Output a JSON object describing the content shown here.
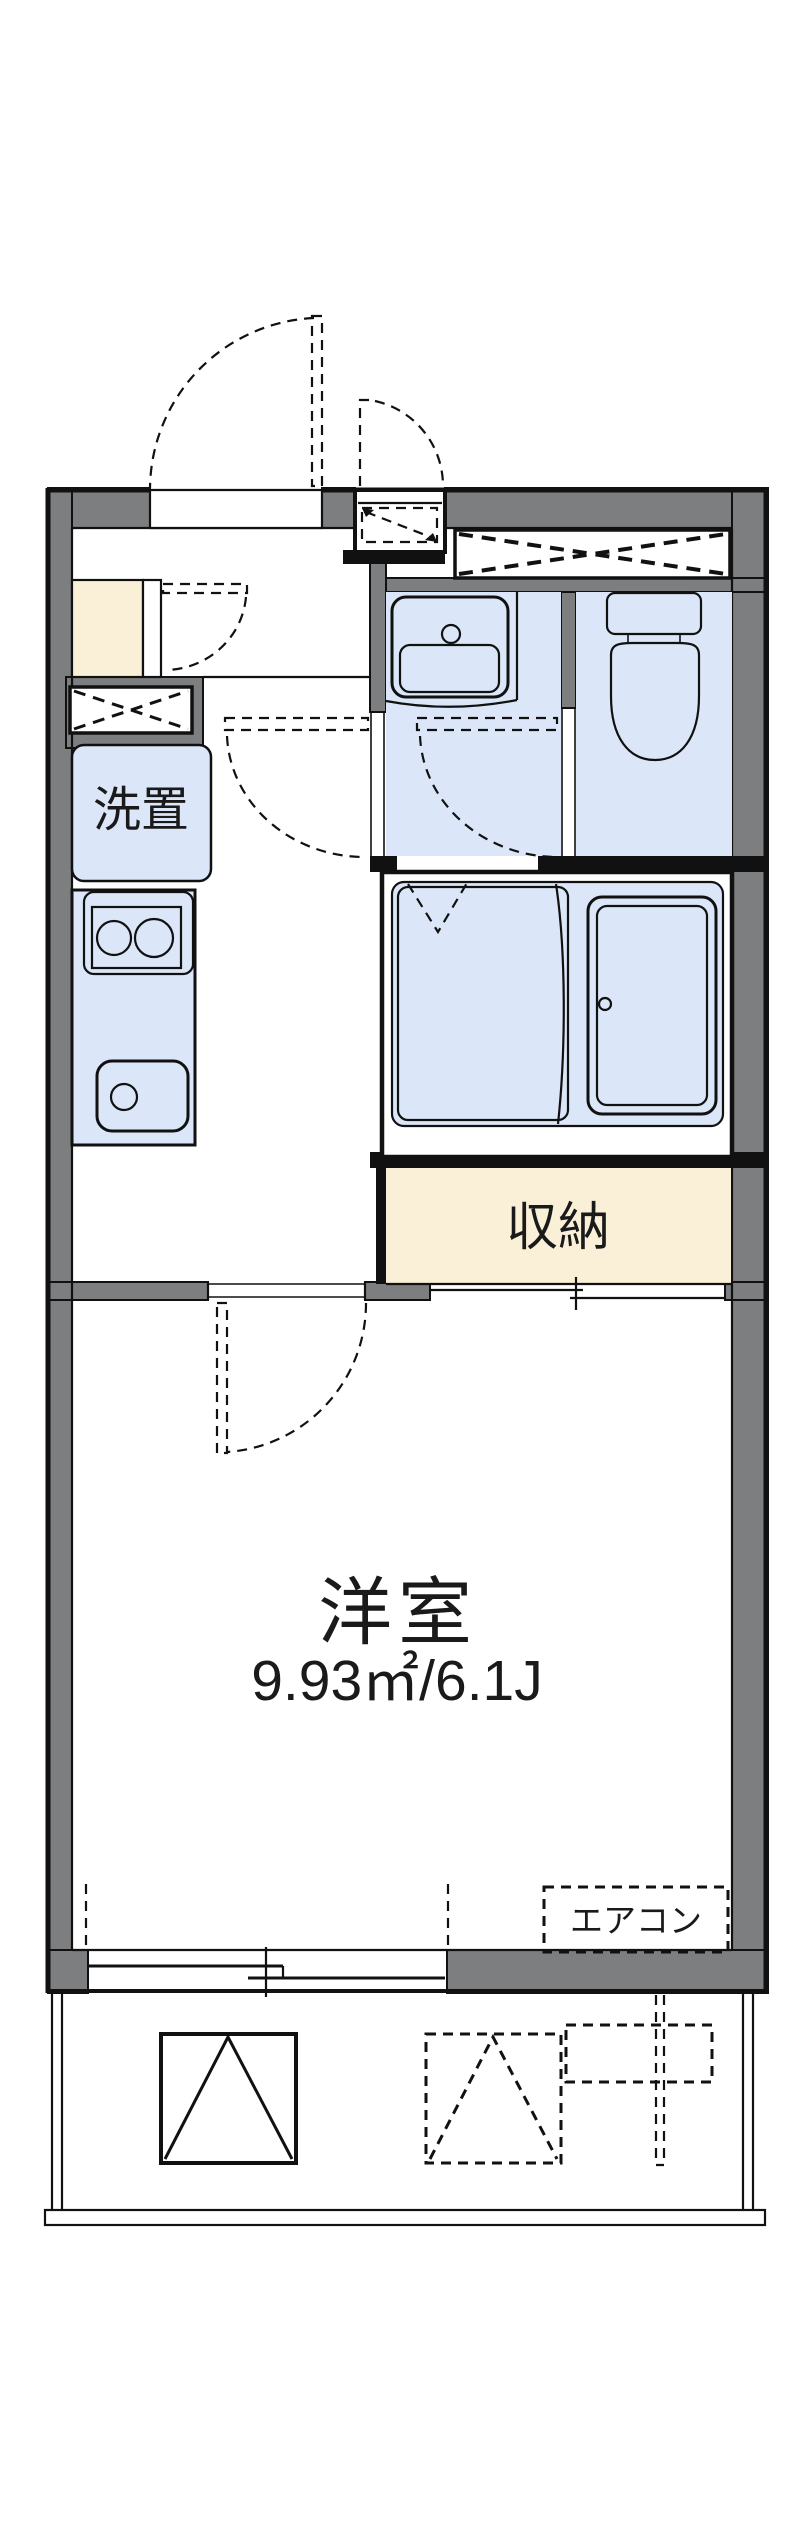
{
  "floorplan": {
    "kind": "japanese-apartment-floor-plan",
    "labels": {
      "laundry": "洗置",
      "closet": "収納",
      "room": "洋室",
      "room_area": "9.93㎡/6.1J",
      "aircon": "エアコン"
    },
    "colors": {
      "wall_gray": "#7c7e80",
      "room_blue": "#dbe7f8",
      "accent_cream": "#faf0d8",
      "line_black": "#111111",
      "background": "#ffffff"
    }
  }
}
